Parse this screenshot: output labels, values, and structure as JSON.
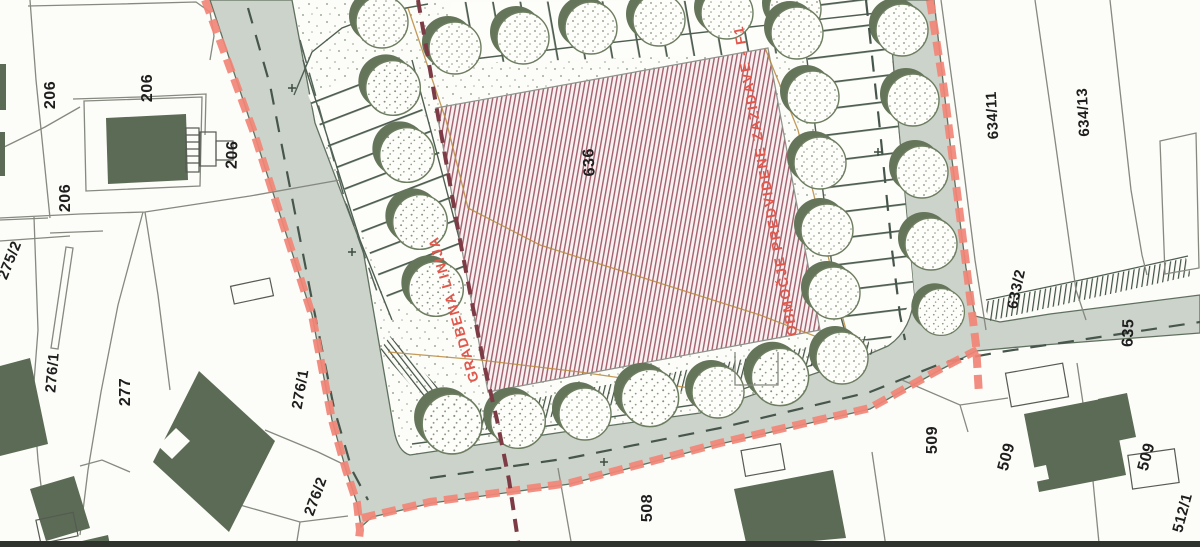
{
  "labels": {
    "p206_a": "206",
    "p206_b": "206",
    "p206_c": "206",
    "p206_d": "206",
    "p275_2": "275/2",
    "p276_1a": "276/1",
    "p277": "277",
    "p276_1b": "276/1",
    "p276_2": "276/2",
    "p636": "636",
    "p634_11": "634/11",
    "p634_13": "634/13",
    "p633_2": "633/2",
    "p635": "635",
    "p509_a": "509",
    "p509_b": "509",
    "p509_c": "509",
    "p512_1": "512/1",
    "p508": "508"
  },
  "red_labels": {
    "building_line": "GRADBENA LINIJA",
    "zone": "OBMOČJE PREDVIDENE ZAZIDAVE - F1"
  },
  "colors": {
    "road": "#ccd3ca",
    "building": "#5c6b55",
    "boundary_red": "#f28577",
    "hatch_stripe": "#a2606c",
    "hatch_bg": "#f8f0f1",
    "tree_green": "#65755a",
    "red_text": "#e2574c",
    "building_line_dash": "#7d3c45",
    "parcel_line": "#85897f",
    "utility_line": "#b98a3e",
    "label_text": "#1e1e1e"
  }
}
